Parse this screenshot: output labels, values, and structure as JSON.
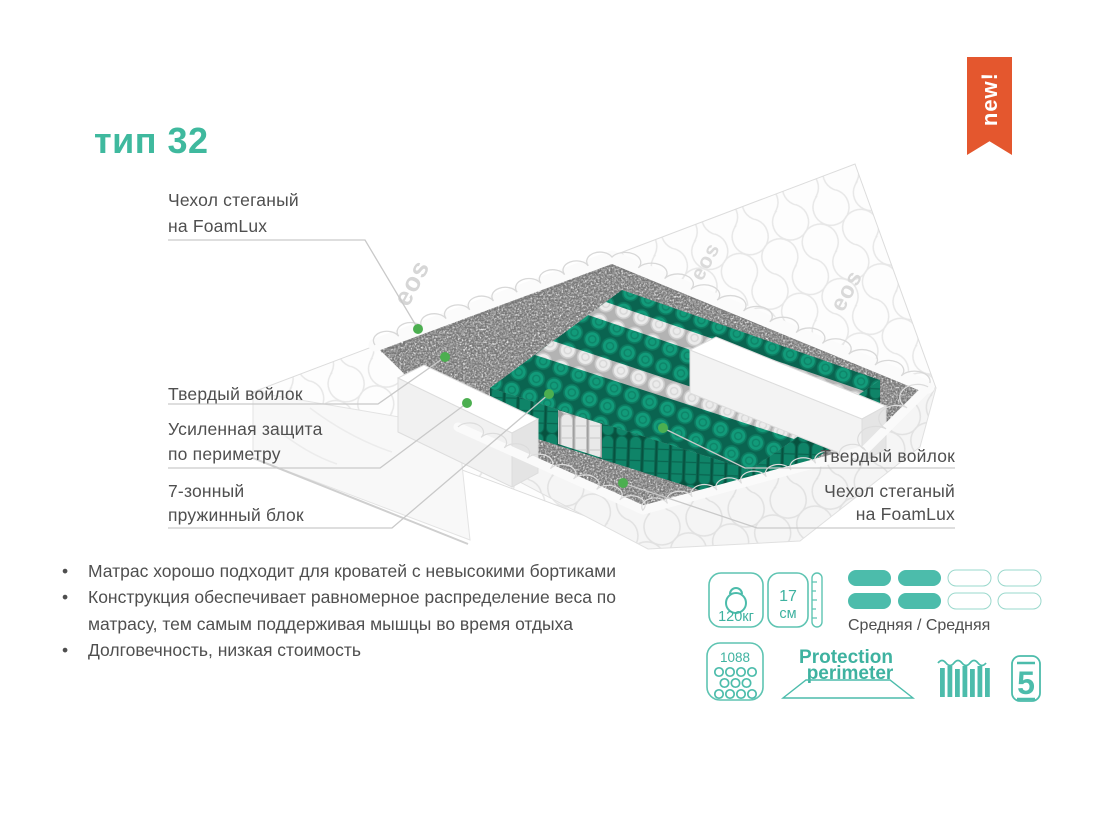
{
  "title": "тип 32",
  "ribbon_label": "new!",
  "watermark": "eos",
  "callouts": {
    "cover_left_1": "Чехол стеганый",
    "cover_left_2": "на FoamLux",
    "felt_left": "Твердый войлок",
    "perimeter_1": "Усиленная защита",
    "perimeter_2": "по периметру",
    "springs_1": "7-зонный",
    "springs_2": "пружинный блок",
    "felt_right": "Твердый войлок",
    "cover_right_1": "Чехол стеганый",
    "cover_right_2": "на FoamLux"
  },
  "features": [
    "Матрас хорошо подходит для кроватей с невысокими бортиками",
    "Конструкция обеспечивает равномерное распределение веса по матрасу, тем самым поддерживая мышцы во время отдыха",
    "Долговечность, низкая стоимость"
  ],
  "specs": {
    "max_weight": "120кг",
    "height_value": "17",
    "height_unit": "см",
    "firmness_label": "Средняя / Средняя",
    "firmness_filled": 2,
    "firmness_total": 4,
    "springs_count": "1088",
    "protection_1": "Protection",
    "protection_2": "perimeter",
    "warranty_years": "5"
  },
  "colors": {
    "accent_teal": "#3eb2a0",
    "ribbon_orange": "#e4572e",
    "spring_teal": "#0e8a6e",
    "dot_green": "#4caf50",
    "text_gray": "#4f4f4f"
  }
}
